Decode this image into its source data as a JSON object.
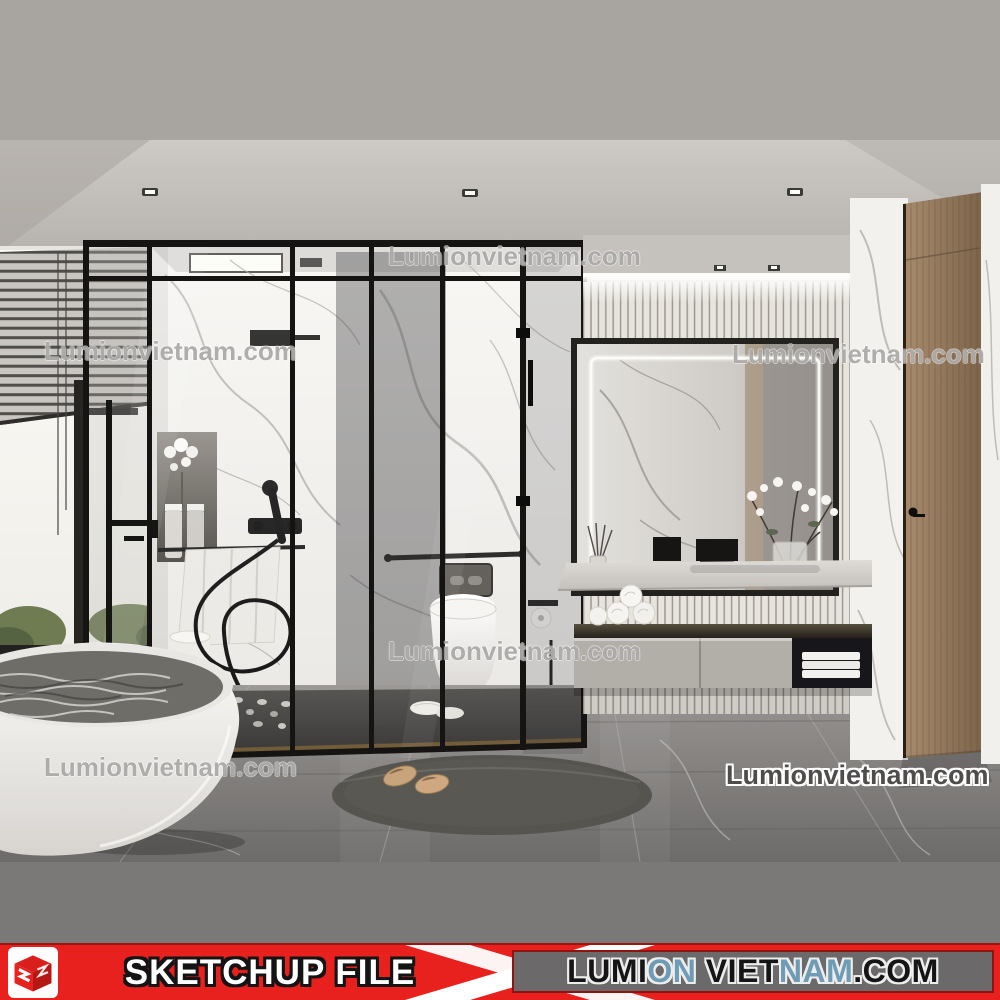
{
  "watermark": {
    "text": "Lumionvietnam.com"
  },
  "banner": {
    "file_label": "SKETCHUP FILE",
    "site_name_segments": [
      {
        "text": "LUMI",
        "color": "#151515"
      },
      {
        "text": "ON",
        "color": "#6f9cb5"
      },
      {
        "text": " VIET",
        "color": "#151515"
      },
      {
        "text": "NAM",
        "color": "#6f9cb5"
      },
      {
        "text": ".COM",
        "color": "#151515"
      }
    ],
    "logo": "sketchup-cube-logo",
    "colors": {
      "banner_red": "#e8211e",
      "banner_box_gray": "#6b696a",
      "accent_blue": "#6f9cb5",
      "top_band_gray": "#a8a5a1",
      "bottom_band_gray": "#7b7978"
    }
  },
  "scene": {
    "type": "3d-interior-render",
    "room": "modern marble bathroom",
    "objects": [
      "ceiling-spotlights",
      "window-blinds",
      "freestanding-bathtub",
      "floor-mounted-tub-faucet",
      "glass-shower-enclosure",
      "rain-shower-head",
      "hand-shower",
      "wall-niche-with-flowers",
      "towel-on-rail",
      "wall-hung-toilet",
      "flush-plate",
      "grab-bar",
      "toilet-paper-holder",
      "toilet-brush",
      "led-mirror",
      "vertical-slat-tile-wall",
      "vanity-countertop",
      "vase-of-flowers",
      "floating-vanity-cabinet",
      "rolled-towels",
      "folded-towels",
      "wood-door",
      "oval-rug",
      "slippers"
    ]
  }
}
